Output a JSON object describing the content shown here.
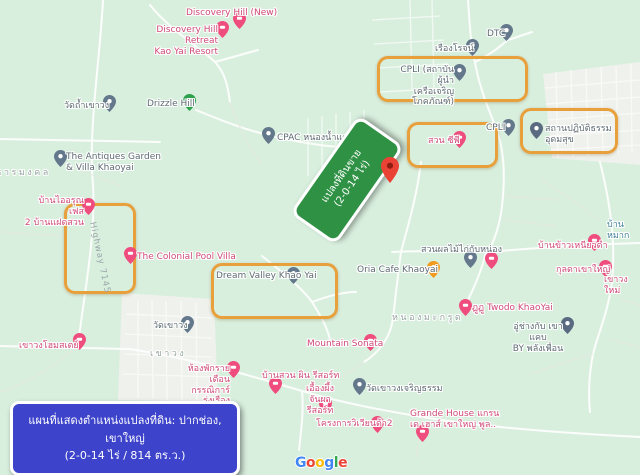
{
  "map": {
    "background_color": "#d9efde",
    "highlight_color": "#e8a03c",
    "marker_colors": {
      "pink": "#ee4d7d",
      "gray": "#64788c",
      "darkgray": "#5a6a80",
      "green": "#2da14c",
      "orange": "#f09b1e",
      "red": "#EA4335"
    },
    "label_colors": {
      "pink": "#d04a78",
      "gray": "#5d6b72",
      "blue": "#44809b",
      "area": "#96a5a0",
      "road": "#9aa5a8"
    },
    "highlights": [
      {
        "id": "highlight-cpli-institute",
        "x": 377,
        "y": 56,
        "w": 145,
        "h": 40
      },
      {
        "id": "highlight-meditation-center",
        "x": 520,
        "y": 108,
        "w": 92,
        "h": 40
      },
      {
        "id": "highlight-suan-cp",
        "x": 407,
        "y": 122,
        "w": 85,
        "h": 40
      },
      {
        "id": "highlight-highway-7145",
        "x": 64,
        "y": 203,
        "w": 66,
        "h": 85
      },
      {
        "id": "highlight-dream-valley",
        "x": 211,
        "y": 263,
        "w": 121,
        "h": 50
      }
    ],
    "markers": [
      {
        "id": "discovery-hill-new",
        "x": 239,
        "y": 20,
        "type": "pink"
      },
      {
        "id": "discovery-hill-retreat",
        "x": 222,
        "y": 29,
        "type": "pink"
      },
      {
        "id": "wat-tham-khao-wong",
        "x": 109,
        "y": 103,
        "type": "gray"
      },
      {
        "id": "drizzle-hill",
        "x": 189,
        "y": 102,
        "type": "green"
      },
      {
        "id": "antiques-garden",
        "x": 60,
        "y": 158,
        "type": "gray"
      },
      {
        "id": "cpac-nong-nam-daeng",
        "x": 268,
        "y": 135,
        "type": "gray"
      },
      {
        "id": "cpli-institute",
        "x": 459,
        "y": 72,
        "type": "gray"
      },
      {
        "id": "rueang-rot",
        "x": 472,
        "y": 47,
        "type": "gray"
      },
      {
        "id": "dtc",
        "x": 506,
        "y": 32,
        "type": "gray"
      },
      {
        "id": "cpli",
        "x": 508,
        "y": 127,
        "type": "gray"
      },
      {
        "id": "meditation-center",
        "x": 536,
        "y": 130,
        "type": "darkgray"
      },
      {
        "id": "suan-cp",
        "x": 459,
        "y": 139,
        "type": "pink"
      },
      {
        "id": "baan-ai-arun",
        "x": 88,
        "y": 206,
        "type": "pink"
      },
      {
        "id": "colonial-pool-villa",
        "x": 130,
        "y": 255,
        "type": "pink"
      },
      {
        "id": "dream-valley",
        "x": 293,
        "y": 275,
        "type": "gray"
      },
      {
        "id": "oria-cafe",
        "x": 433,
        "y": 269,
        "type": "orange"
      },
      {
        "id": "suan-phonlamai",
        "x": 470,
        "y": 259,
        "type": "gray"
      },
      {
        "id": "poi-unlabeled",
        "x": 491,
        "y": 260,
        "type": "pink"
      },
      {
        "id": "baan-khao-niao-dam",
        "x": 594,
        "y": 242,
        "type": "pink"
      },
      {
        "id": "kunlada-khaoyai",
        "x": 605,
        "y": 268,
        "type": "pink"
      },
      {
        "id": "twodo-khaoyai",
        "x": 465,
        "y": 307,
        "type": "pink"
      },
      {
        "id": "mountain-sonata",
        "x": 370,
        "y": 342,
        "type": "pink"
      },
      {
        "id": "au-chang",
        "x": 567,
        "y": 325,
        "type": "darkgray"
      },
      {
        "id": "khao-wong-homestay",
        "x": 79,
        "y": 341,
        "type": "pink"
      },
      {
        "id": "wat-khao-wong",
        "x": 187,
        "y": 324,
        "type": "gray"
      },
      {
        "id": "monthly-room",
        "x": 233,
        "y": 369,
        "type": "pink"
      },
      {
        "id": "baan-suan-phin",
        "x": 275,
        "y": 385,
        "type": "pink"
      },
      {
        "id": "ueang-phueng",
        "x": 325,
        "y": 405,
        "type": "pink"
      },
      {
        "id": "wat-khao-wong-charoen-tham",
        "x": 359,
        "y": 386,
        "type": "gray"
      },
      {
        "id": "viviana-2",
        "x": 377,
        "y": 424,
        "type": "pink"
      },
      {
        "id": "grande-house",
        "x": 422,
        "y": 433,
        "type": "pink"
      }
    ],
    "labels": [
      {
        "id": "discovery-hill-new",
        "text": "Discovery Hill (New)",
        "x": 186,
        "y": 8,
        "color": "pink"
      },
      {
        "id": "discovery-hill-retreat",
        "text": "Discovery Hill Retreat\nKao Yai Resort",
        "x": 146,
        "y": 25,
        "color": "pink",
        "align": "right",
        "w": 72
      },
      {
        "id": "wat-tham-khao-wong",
        "text": "วัดถ้ำเขาวง",
        "x": 64,
        "y": 101,
        "color": "gray"
      },
      {
        "id": "drizzle-hill",
        "text": "Drizzle Hill",
        "x": 147,
        "y": 99,
        "color": "gray"
      },
      {
        "id": "antiques-garden",
        "text": "The Antiques Garden\n& Villa Khaoyai",
        "x": 66,
        "y": 152,
        "color": "gray"
      },
      {
        "id": "cpac-nong-nam-daeng",
        "text": "CPAC หนองน้ำแดง",
        "x": 277,
        "y": 133,
        "color": "gray"
      },
      {
        "id": "cpli-institute",
        "text": "CPLI (สถาบันผู้นำ\nเครือเจริญโภคภัณฑ์)",
        "x": 396,
        "y": 65,
        "color": "gray",
        "align": "right",
        "w": 58
      },
      {
        "id": "rueang-rot",
        "text": "เรืองโรจน์",
        "x": 435,
        "y": 44,
        "color": "gray"
      },
      {
        "id": "dtc",
        "text": "DTC",
        "x": 487,
        "y": 29,
        "color": "gray"
      },
      {
        "id": "cpli",
        "text": "CPLI",
        "x": 486,
        "y": 123,
        "color": "gray"
      },
      {
        "id": "meditation-center",
        "text": "สถานปฏิบัติธรรม\nอุดมสุข",
        "x": 545,
        "y": 124,
        "color": "gray"
      },
      {
        "id": "suan-cp",
        "text": "สวน ซีพี",
        "x": 428,
        "y": 136,
        "color": "pink"
      },
      {
        "id": "baan-ai-arun",
        "text": "บ้านไออรุณ เฟส\n2 บ้านแฝดสวน",
        "x": 24,
        "y": 196,
        "color": "pink",
        "align": "right",
        "w": 60
      },
      {
        "id": "highway-7145",
        "text": "Highway 7145",
        "x": 97,
        "y": 221,
        "color": "road",
        "rotate": 78
      },
      {
        "id": "colonial-pool-villa",
        "text": "The Colonial Pool Villa",
        "x": 137,
        "y": 252,
        "color": "pink"
      },
      {
        "id": "dream-valley",
        "text": "Dream Valley Khao Yai",
        "x": 216,
        "y": 271,
        "color": "gray"
      },
      {
        "id": "oria-cafe",
        "text": "Oria Cafe Khaoyai",
        "x": 357,
        "y": 265,
        "color": "gray"
      },
      {
        "id": "suan-phonlamai",
        "text": "สวนผลไม้ไก่กับหน่อง",
        "x": 421,
        "y": 245,
        "color": "gray"
      },
      {
        "id": "baan-khao-niao-dam",
        "text": "บ้านข้าวเหนียวดำ",
        "x": 538,
        "y": 241,
        "color": "pink"
      },
      {
        "id": "kunlada-khaoyai",
        "text": "กุลดาเขาใหญ่",
        "x": 556,
        "y": 265,
        "color": "pink"
      },
      {
        "id": "ban-mak",
        "text": "บ้านหมาก",
        "x": 607,
        "y": 220,
        "color": "blue"
      },
      {
        "id": "khao-wong-mai",
        "text": "เขาวงใหม่",
        "x": 604,
        "y": 275,
        "color": "pink"
      },
      {
        "id": "twodo-khaoyai",
        "text": "ฏูฏู Twodo KhaoYai",
        "x": 472,
        "y": 303,
        "color": "pink"
      },
      {
        "id": "mountain-sonata",
        "text": "Mountain Sonata",
        "x": 307,
        "y": 339,
        "color": "pink"
      },
      {
        "id": "au-chang",
        "text": "อู่ช่างกับ เขาแคบ\nBY พลังเพื่อน",
        "x": 512,
        "y": 322,
        "color": "gray",
        "align": "center",
        "w": 52
      },
      {
        "id": "nong-makrut",
        "text": "หนองมะกรูด",
        "x": 392,
        "y": 313,
        "color": "area"
      },
      {
        "id": "khao-wong-homestay",
        "text": "เขาวงโฮมสเตย์",
        "x": 19,
        "y": 341,
        "color": "pink"
      },
      {
        "id": "wat-khao-wong",
        "text": "วัดเขาวง",
        "x": 153,
        "y": 321,
        "color": "gray"
      },
      {
        "id": "khao-wong-area",
        "text": "เขาวง",
        "x": 150,
        "y": 349,
        "color": "area"
      },
      {
        "id": "monthly-room",
        "text": "ห้องพักรายเดือน\nกรรณิการ์รุ่งเรือง",
        "x": 174,
        "y": 364,
        "color": "pink",
        "align": "right",
        "w": 56
      },
      {
        "id": "baan-suan-phin",
        "text": "บ้านสวน ผิน รีสอร์ท",
        "x": 262,
        "y": 371,
        "color": "pink"
      },
      {
        "id": "ueang-phueng",
        "text": "เอื้องผึ้ง\nจันผารีสอร์ท",
        "x": 298,
        "y": 384,
        "color": "pink",
        "align": "center",
        "w": 44
      },
      {
        "id": "wat-khao-wong-charoen-tham",
        "text": "วัดเขาวงเจริญธรรม",
        "x": 366,
        "y": 384,
        "color": "gray"
      },
      {
        "id": "viviana-2",
        "text": "โครงการวิเวียนด้า2",
        "x": 316,
        "y": 419,
        "color": "pink"
      },
      {
        "id": "grande-house",
        "text": "Grande House แกรน\nเด เฮาส์ เขาใหญ่ พูล..",
        "x": 410,
        "y": 409,
        "color": "pink"
      },
      {
        "id": "than-mongkhon",
        "text": "ธารมงคล",
        "x": -4,
        "y": 168,
        "color": "area"
      }
    ],
    "property_label": {
      "line1": "แปลงที่ดินขาย",
      "line2": "(2-0-14 ไร่)",
      "bg": "#2e9144",
      "rotation": -55
    },
    "property_pin": {
      "x": 390,
      "y": 168,
      "color": "#EA4335"
    },
    "caption": {
      "line1": "แผนที่แสดงตำแหน่งแปลงที่ดิน: ปากช่อง, เขาใหญ่",
      "line2": "(2-0-14 ไร่ / 814 ตร.ว.)",
      "bg": "#3d43ca"
    },
    "attribution": {
      "letters": [
        {
          "ch": "G",
          "color": "#4285F4"
        },
        {
          "ch": "o",
          "color": "#EA4335"
        },
        {
          "ch": "o",
          "color": "#FBBC05"
        },
        {
          "ch": "g",
          "color": "#4285F4"
        },
        {
          "ch": "l",
          "color": "#34A853"
        },
        {
          "ch": "e",
          "color": "#EA4335"
        }
      ]
    }
  }
}
